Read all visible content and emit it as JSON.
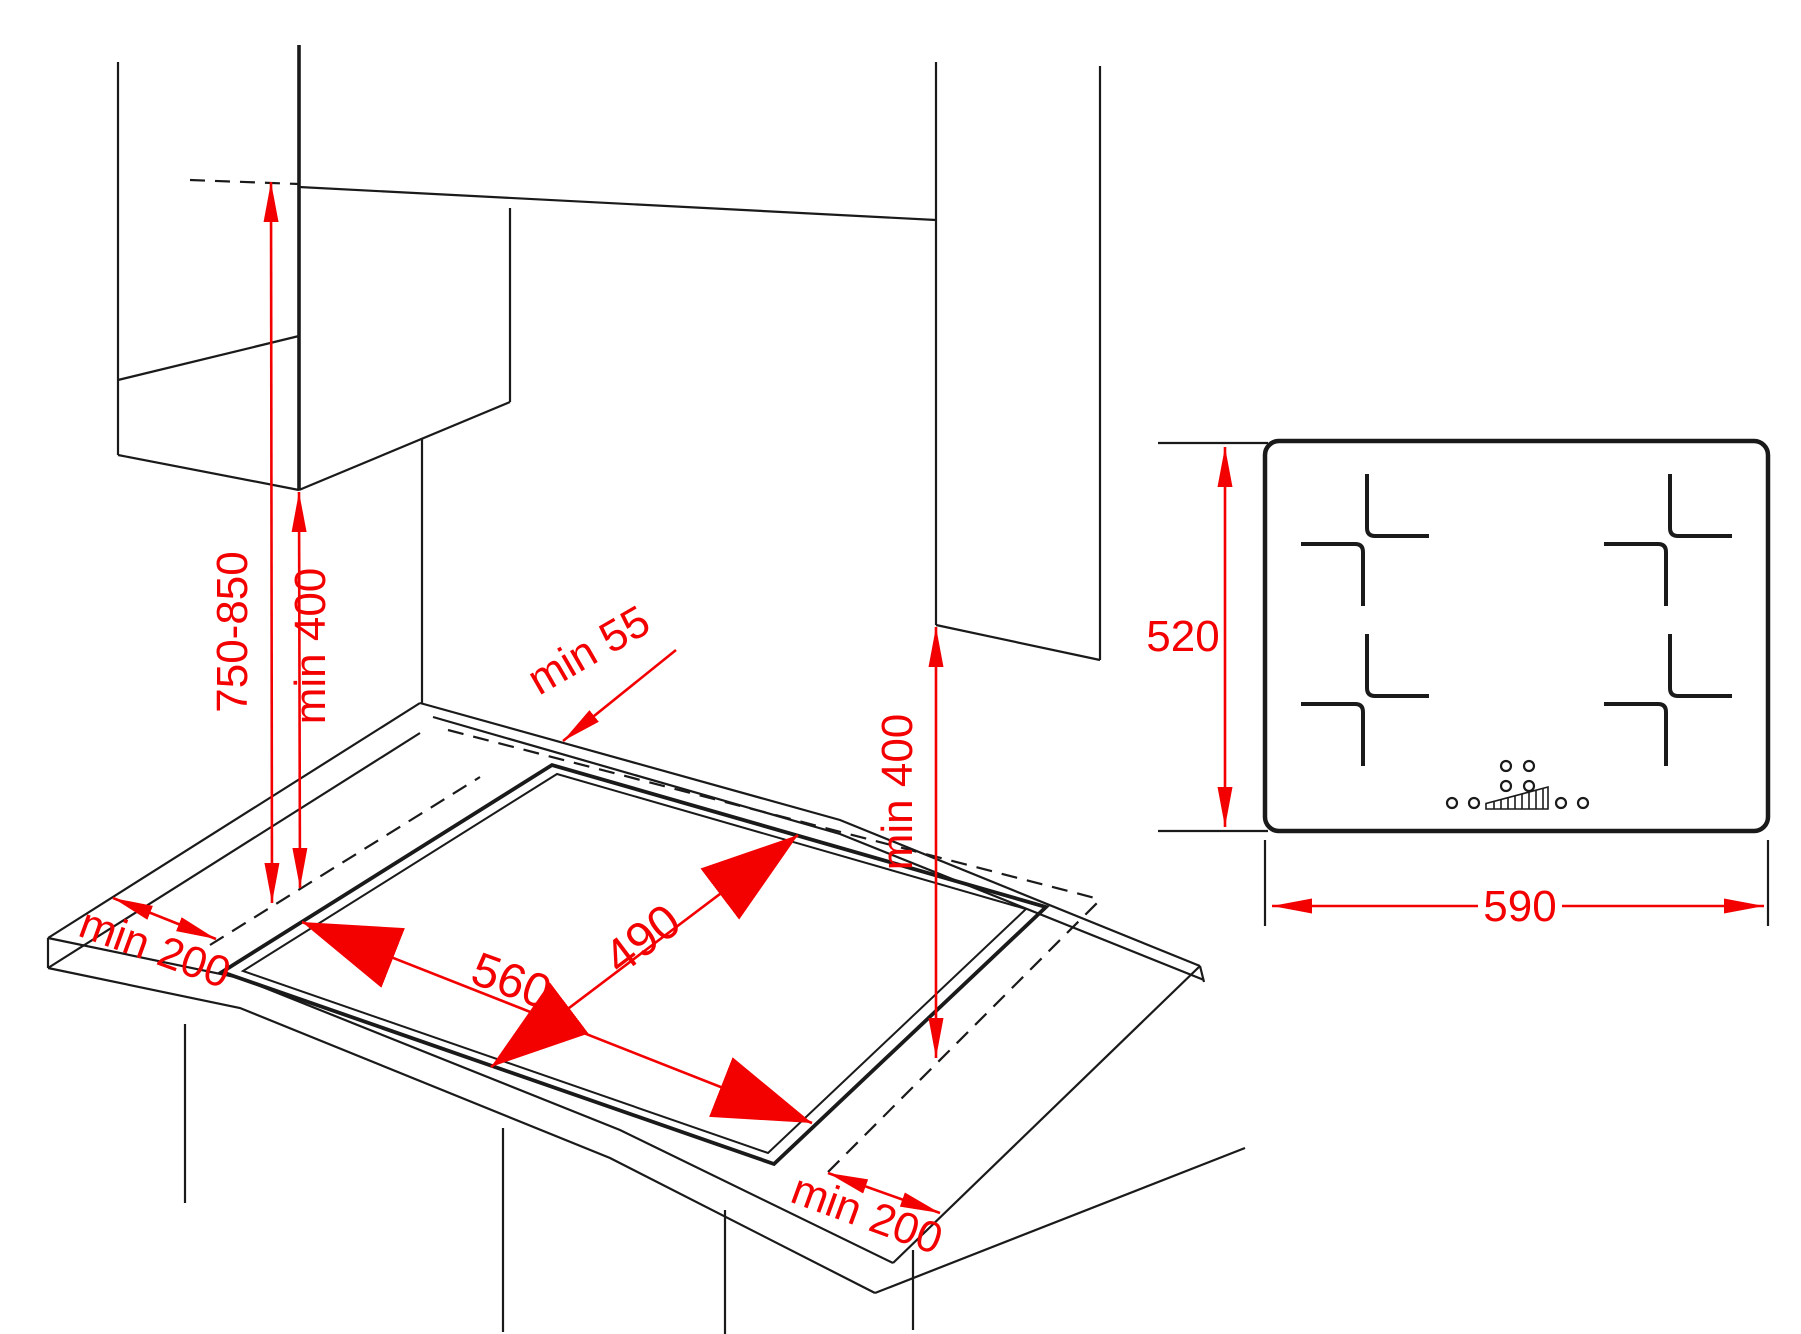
{
  "diagram_title": "hob-installation-dimensions",
  "colors": {
    "dimension_red": "#f30000",
    "line_black": "#1a1a1a",
    "background": "#ffffff"
  },
  "perspective_view": {
    "labels": {
      "hood_height_range": "750-850",
      "hood_min_clearance": "min 400",
      "rear_min_distance": "min 55",
      "left_min_distance": "min 200",
      "cutout_width": "560",
      "cutout_depth": "490",
      "side_panel_min_clearance": "min 400",
      "right_min_distance": "min 200"
    }
  },
  "top_view": {
    "labels": {
      "hob_depth": "520",
      "hob_width": "590"
    },
    "burner_count": 4
  }
}
